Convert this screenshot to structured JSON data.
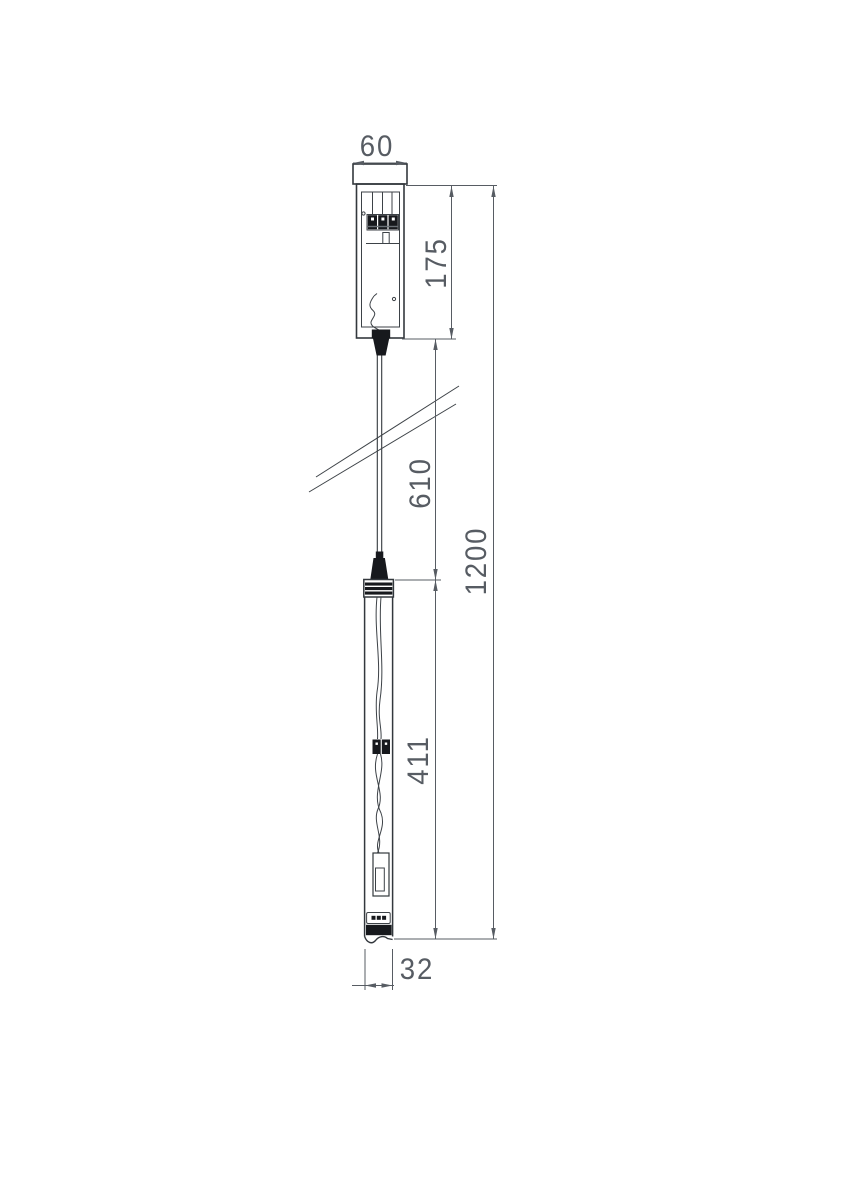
{
  "drawing": {
    "type": "technical-dimension-drawing",
    "subject": "pendant-light-fixture-side-view",
    "dimensions": {
      "canopy_width": "60",
      "canopy_height": "175",
      "cable_section": "610",
      "lamp_body_length": "411",
      "overall_length": "1200",
      "lamp_diameter": "32"
    },
    "colors": {
      "background": "#ffffff",
      "outline": "#33383d",
      "dimension_lines": "#575c63",
      "dimension_text": "#575c63",
      "dark_fill": "#17191d"
    }
  }
}
